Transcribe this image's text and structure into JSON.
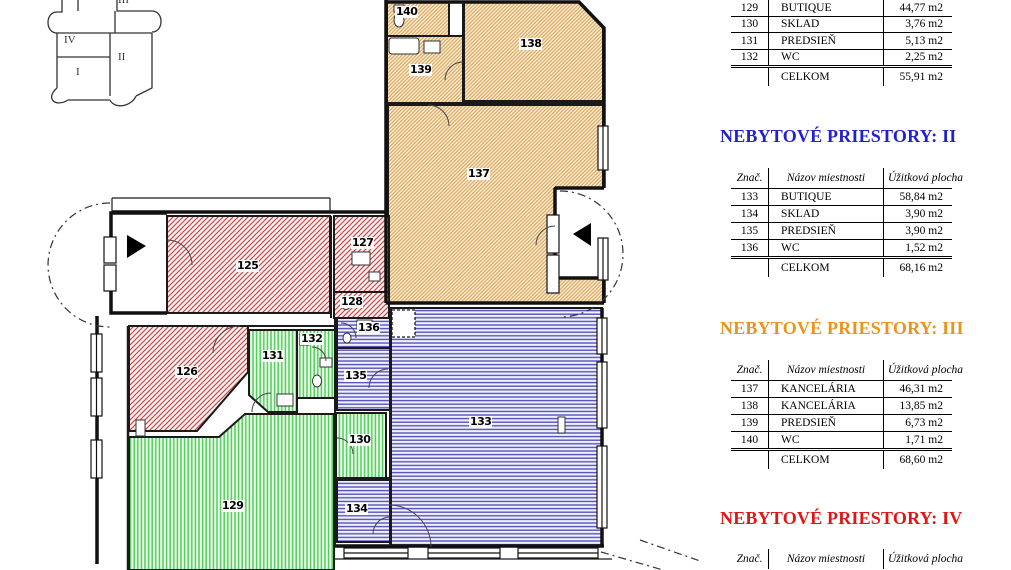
{
  "minimap": {
    "labels": [
      {
        "text": "I"
      },
      {
        "text": "II"
      },
      {
        "text": "III"
      },
      {
        "text": "IV"
      }
    ]
  },
  "plan": {
    "room_labels": [
      {
        "number": "125"
      },
      {
        "number": "126"
      },
      {
        "number": "127"
      },
      {
        "number": "128"
      },
      {
        "number": "129"
      },
      {
        "number": "130"
      },
      {
        "number": "131"
      },
      {
        "number": "132"
      },
      {
        "number": "133"
      },
      {
        "number": "134"
      },
      {
        "number": "135"
      },
      {
        "number": "136"
      },
      {
        "number": "137"
      },
      {
        "number": "138"
      },
      {
        "number": "139"
      },
      {
        "number": "140"
      }
    ],
    "zones": [
      {
        "id": "I",
        "pattern": "green-vertical-stripes",
        "color": "#4ecf58",
        "rooms": [
          "129",
          "130",
          "131",
          "132"
        ]
      },
      {
        "id": "II",
        "pattern": "blue-horizontal-stripes",
        "color": "#5552bb",
        "rooms": [
          "133",
          "134",
          "135",
          "136"
        ]
      },
      {
        "id": "III",
        "pattern": "tan-diagonal-hatch",
        "color": "#dca45a",
        "rooms": [
          "137",
          "138",
          "139",
          "140"
        ]
      },
      {
        "id": "IV",
        "pattern": "red-diagonal-hatch",
        "color": "#c94b4b",
        "rooms": [
          "125",
          "126",
          "127",
          "128"
        ]
      }
    ]
  },
  "sections": [
    {
      "rows": [
        [
          "129",
          "BUTIQUE",
          "44,77 m2"
        ],
        [
          "130",
          "SKLAD",
          "3,76 m2"
        ],
        [
          "131",
          "PREDSIEŇ",
          "5,13 m2"
        ],
        [
          "132",
          "WC",
          "2,25 m2"
        ]
      ],
      "total_label": "CELKOM",
      "total_value": "55,91 m2"
    },
    {
      "title": "NEBYTOVÉ PRIESTORY: II",
      "title_color": "#2222cc",
      "header": [
        "Znač.",
        "Názov miestnosti",
        "Úžitková plocha"
      ],
      "rows": [
        [
          "133",
          "BUTIQUE",
          "58,84 m2"
        ],
        [
          "134",
          "SKLAD",
          "3,90 m2"
        ],
        [
          "135",
          "PREDSIEŇ",
          "3,90 m2"
        ],
        [
          "136",
          "WC",
          "1,52 m2"
        ]
      ],
      "total_label": "CELKOM",
      "total_value": "68,16 m2"
    },
    {
      "title": "NEBYTOVÉ PRIESTORY: III",
      "title_color": "#e8941f",
      "header": [
        "Znač.",
        "Názov miestnosti",
        "Úžitková plocha"
      ],
      "rows": [
        [
          "137",
          "KANCELÁRIA",
          "46,31 m2"
        ],
        [
          "138",
          "KANCELÁRIA",
          "13,85 m2"
        ],
        [
          "139",
          "PREDSIEŇ",
          "6,73 m2"
        ],
        [
          "140",
          "WC",
          "1,71 m2"
        ]
      ],
      "total_label": "CELKOM",
      "total_value": "68,60 m2"
    },
    {
      "title": "NEBYTOVÉ PRIESTORY: IV",
      "title_color": "#e01515",
      "header": [
        "Znač.",
        "Názov miestnosti",
        "Úžitková plocha"
      ]
    }
  ]
}
